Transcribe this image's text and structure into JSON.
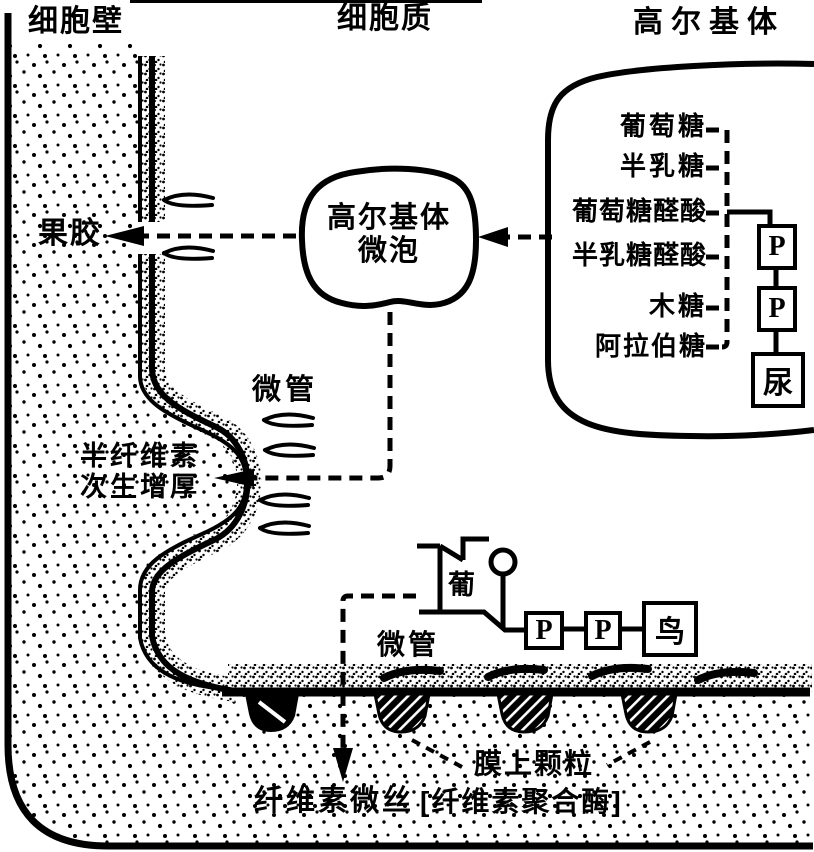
{
  "headers": {
    "cell_wall": "细胞壁",
    "cytoplasm": "细胞质",
    "golgi_body": "高尔基体"
  },
  "labels": {
    "pectin": "果胶",
    "microtubule_upper": "微管",
    "microtubule_lower": "微管",
    "hemicellulose_line1": "半纤维素",
    "hemicellulose_line2": "次生增厚",
    "glucose_ring": "葡",
    "cellulose_microfibril": "纤维素微丝",
    "membrane_particle": "膜上颗粒",
    "cellulose_polymerase": "[纤维素聚合酶]"
  },
  "vesicle": {
    "line1": "高尔基体",
    "line2": "微泡"
  },
  "golgi_sugars": [
    "葡萄糖",
    "半乳糖",
    "葡萄糖醛酸",
    "半乳糖醛酸",
    "木糖",
    "阿拉伯糖"
  ],
  "udp": {
    "p1": "P",
    "p2": "P",
    "base": "尿"
  },
  "gdp": {
    "p1": "P",
    "p2": "P",
    "base": "鸟"
  },
  "colors": {
    "ink": "#000000",
    "paper": "#ffffff"
  }
}
